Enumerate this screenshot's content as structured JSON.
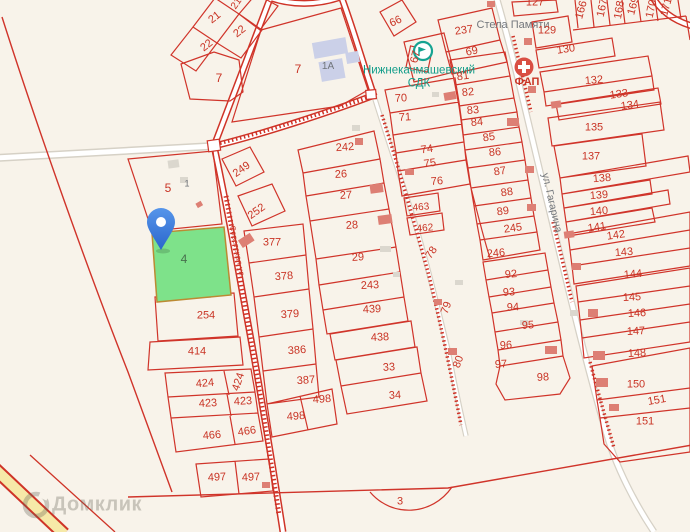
{
  "app": {
    "watermark": "Домклик"
  },
  "map": {
    "background_color": "#f8f3ea",
    "parcel_line_color": "#d0342a",
    "selected_parcel": {
      "number": "4",
      "fill_color": "#7ee28a",
      "pin_color": "#3579dd"
    },
    "streets": {
      "gagarina": "ул. Гагарина",
      "left_street": "Советская ул."
    },
    "poi": {
      "culture_house_line1": "Нижнекачмашевский",
      "culture_house_line2": "СДК",
      "medical_point": "ФАП",
      "memorial": "Стела Памяти"
    },
    "parcel_labels": [
      {
        "t": "21",
        "x": 215,
        "y": 18,
        "r": -38
      },
      {
        "t": "21",
        "x": 237,
        "y": 4,
        "r": -55,
        "fs": 10
      },
      {
        "t": "22",
        "x": 207,
        "y": 46,
        "r": -38
      },
      {
        "t": "22",
        "x": 240,
        "y": 32,
        "r": -38
      },
      {
        "t": "7",
        "x": 219,
        "y": 78,
        "fs": 12
      },
      {
        "t": "7",
        "x": 298,
        "y": 69,
        "fs": 12
      },
      {
        "t": "1А",
        "x": 328,
        "y": 67,
        "c": "gray",
        "fs": 10
      },
      {
        "t": "5",
        "x": 168,
        "y": 188,
        "fs": 12
      },
      {
        "t": "1",
        "x": 187,
        "y": 184,
        "c": "gray",
        "fs": 9
      },
      {
        "t": "4",
        "x": 184,
        "y": 259,
        "c": "green",
        "fs": 12
      },
      {
        "t": "249",
        "x": 242,
        "y": 170,
        "r": -35
      },
      {
        "t": "252",
        "x": 257,
        "y": 212,
        "r": -35
      },
      {
        "t": "254",
        "x": 206,
        "y": 316
      },
      {
        "t": "414",
        "x": 197,
        "y": 352
      },
      {
        "t": "424",
        "x": 205,
        "y": 384,
        "r": -5
      },
      {
        "t": "424",
        "x": 239,
        "y": 382,
        "r": -72
      },
      {
        "t": "423",
        "x": 208,
        "y": 404,
        "r": -3
      },
      {
        "t": "423",
        "x": 243,
        "y": 402,
        "r": -3
      },
      {
        "t": "466",
        "x": 212,
        "y": 436,
        "r": -5
      },
      {
        "t": "466",
        "x": 247,
        "y": 432,
        "r": -8
      },
      {
        "t": "497",
        "x": 217,
        "y": 478,
        "r": -3
      },
      {
        "t": "497",
        "x": 251,
        "y": 478,
        "r": -3
      },
      {
        "t": "377",
        "x": 272,
        "y": 243
      },
      {
        "t": "378",
        "x": 284,
        "y": 277,
        "r": -4
      },
      {
        "t": "379",
        "x": 290,
        "y": 315,
        "r": -4
      },
      {
        "t": "386",
        "x": 297,
        "y": 351,
        "r": -4
      },
      {
        "t": "387",
        "x": 306,
        "y": 381,
        "r": -4
      },
      {
        "t": "498",
        "x": 322,
        "y": 400,
        "r": -4
      },
      {
        "t": "498",
        "x": 296,
        "y": 417,
        "r": -4
      },
      {
        "t": "242",
        "x": 345,
        "y": 148,
        "r": -4
      },
      {
        "t": "26",
        "x": 341,
        "y": 175,
        "r": -3
      },
      {
        "t": "27",
        "x": 346,
        "y": 196,
        "r": -3
      },
      {
        "t": "28",
        "x": 352,
        "y": 226,
        "r": -3
      },
      {
        "t": "29",
        "x": 358,
        "y": 258,
        "r": -3
      },
      {
        "t": "243",
        "x": 370,
        "y": 286,
        "r": -3
      },
      {
        "t": "439",
        "x": 372,
        "y": 310,
        "r": -3
      },
      {
        "t": "438",
        "x": 380,
        "y": 338,
        "r": -3
      },
      {
        "t": "33",
        "x": 389,
        "y": 368,
        "r": -3
      },
      {
        "t": "34",
        "x": 395,
        "y": 396,
        "r": -3
      },
      {
        "t": "3",
        "x": 400,
        "y": 502
      },
      {
        "t": "66",
        "x": 396,
        "y": 22,
        "r": -25
      },
      {
        "t": "237",
        "x": 464,
        "y": 31,
        "r": -8
      },
      {
        "t": "69",
        "x": 472,
        "y": 52,
        "r": -12
      },
      {
        "t": "67",
        "x": 416,
        "y": 57,
        "r": -75
      },
      {
        "t": "127",
        "x": 535,
        "y": 3
      },
      {
        "t": "70",
        "x": 401,
        "y": 99,
        "r": -3
      },
      {
        "t": "71",
        "x": 405,
        "y": 118,
        "r": -3
      },
      {
        "t": "74",
        "x": 427,
        "y": 150,
        "r": -8
      },
      {
        "t": "75",
        "x": 430,
        "y": 164,
        "r": -8
      },
      {
        "t": "76",
        "x": 437,
        "y": 182,
        "r": -5
      },
      {
        "t": "463",
        "x": 421,
        "y": 208,
        "r": -5,
        "fs": 10
      },
      {
        "t": "462",
        "x": 425,
        "y": 229,
        "r": -5,
        "fs": 10
      },
      {
        "t": "78",
        "x": 432,
        "y": 253,
        "r": -55
      },
      {
        "t": "79",
        "x": 447,
        "y": 308,
        "r": -70
      },
      {
        "t": "80",
        "x": 459,
        "y": 362,
        "r": -70
      },
      {
        "t": "81",
        "x": 463,
        "y": 77,
        "r": -8
      },
      {
        "t": "82",
        "x": 468,
        "y": 93,
        "r": -5
      },
      {
        "t": "83",
        "x": 473,
        "y": 111,
        "r": -5
      },
      {
        "t": "84",
        "x": 477,
        "y": 123,
        "r": -5
      },
      {
        "t": "85",
        "x": 489,
        "y": 138,
        "r": -8
      },
      {
        "t": "86",
        "x": 495,
        "y": 153,
        "r": -5
      },
      {
        "t": "87",
        "x": 500,
        "y": 172,
        "r": -8
      },
      {
        "t": "88",
        "x": 507,
        "y": 193,
        "r": -8
      },
      {
        "t": "89",
        "x": 503,
        "y": 212,
        "r": -8
      },
      {
        "t": "245",
        "x": 513,
        "y": 229,
        "r": -8
      },
      {
        "t": "246",
        "x": 496,
        "y": 254,
        "r": -5
      },
      {
        "t": "92",
        "x": 511,
        "y": 275,
        "r": -5
      },
      {
        "t": "93",
        "x": 509,
        "y": 293,
        "r": -3
      },
      {
        "t": "94",
        "x": 513,
        "y": 308,
        "r": -3
      },
      {
        "t": "95",
        "x": 528,
        "y": 326,
        "r": -3
      },
      {
        "t": "96",
        "x": 506,
        "y": 346,
        "r": -3
      },
      {
        "t": "97",
        "x": 501,
        "y": 365,
        "r": -3
      },
      {
        "t": "98",
        "x": 543,
        "y": 378,
        "r": -3
      },
      {
        "t": "129",
        "x": 547,
        "y": 31
      },
      {
        "t": "130",
        "x": 566,
        "y": 50,
        "r": -8
      },
      {
        "t": "132",
        "x": 594,
        "y": 81,
        "r": -5
      },
      {
        "t": "133",
        "x": 619,
        "y": 95,
        "r": -8
      },
      {
        "t": "134",
        "x": 630,
        "y": 106,
        "r": -8
      },
      {
        "t": "135",
        "x": 594,
        "y": 128
      },
      {
        "t": "137",
        "x": 591,
        "y": 157
      },
      {
        "t": "138",
        "x": 602,
        "y": 179,
        "r": -5
      },
      {
        "t": "139",
        "x": 599,
        "y": 196,
        "r": -5
      },
      {
        "t": "140",
        "x": 599,
        "y": 212,
        "r": -5
      },
      {
        "t": "141",
        "x": 597,
        "y": 228,
        "r": -8
      },
      {
        "t": "142",
        "x": 616,
        "y": 236,
        "r": -8
      },
      {
        "t": "143",
        "x": 624,
        "y": 253,
        "r": -5
      },
      {
        "t": "144",
        "x": 633,
        "y": 275,
        "r": -5
      },
      {
        "t": "145",
        "x": 632,
        "y": 298,
        "r": -3
      },
      {
        "t": "146",
        "x": 637,
        "y": 314,
        "r": -3
      },
      {
        "t": "147",
        "x": 636,
        "y": 332,
        "r": -3
      },
      {
        "t": "148",
        "x": 637,
        "y": 354,
        "r": -3
      },
      {
        "t": "150",
        "x": 636,
        "y": 385
      },
      {
        "t": "151",
        "x": 657,
        "y": 401,
        "r": -10
      },
      {
        "t": "151",
        "x": 645,
        "y": 422
      },
      {
        "t": "166",
        "x": 582,
        "y": 10,
        "r": -75
      },
      {
        "t": "167",
        "x": 603,
        "y": 8,
        "r": -78
      },
      {
        "t": "168",
        "x": 620,
        "y": 10,
        "r": -80
      },
      {
        "t": "169",
        "x": 634,
        "y": 6,
        "r": -75
      },
      {
        "t": "170",
        "x": 652,
        "y": 9,
        "r": -78
      },
      {
        "t": "171",
        "x": 667,
        "y": 7,
        "r": -75
      }
    ]
  }
}
